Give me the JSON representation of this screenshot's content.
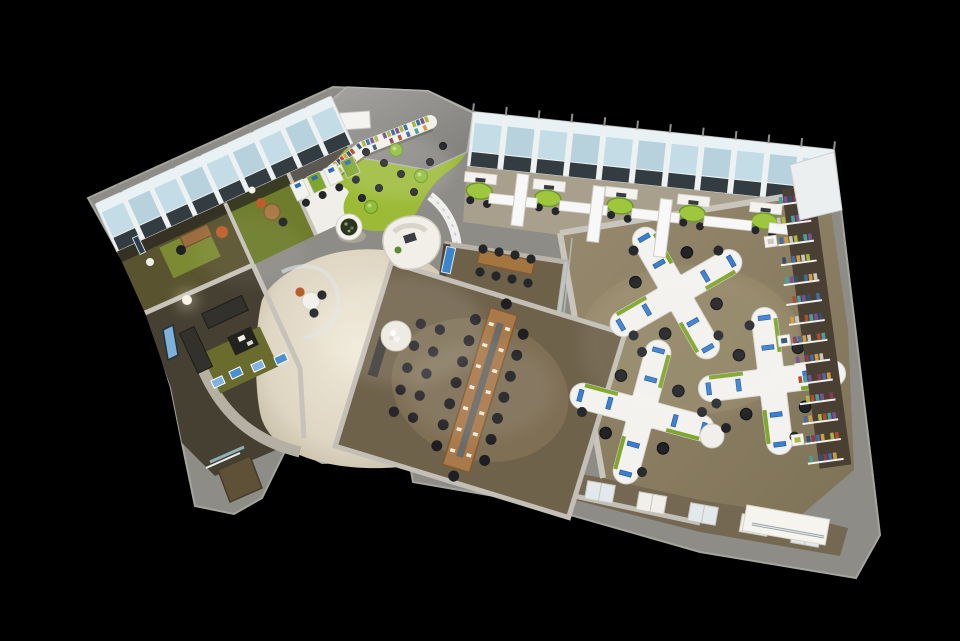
{
  "meta": {
    "description": "3D isometric cutaway rendering of an open-plan office floor plan on a black background",
    "background": "#000000"
  },
  "palette": {
    "outer_wall": "#8d8c86",
    "wall_top": "#c7c3ba",
    "wall_dark_face": "#4e4435",
    "roof": "#9a9995",
    "frame_white": "#eef1f2",
    "glass": "#c3dce6",
    "glass_light": "#e8f1f4",
    "glass_dark_pane": "#1e282e",
    "carpet_open_office": "#8d8169",
    "carpet_conference": "#6f624b",
    "pods_floor": "#a89f8d",
    "lobby_beige": "#ded5c2",
    "lobby_highlight": "#f0e9d8",
    "floor_green": "#9cba36",
    "table_green": "#9ec73e",
    "rug_olive": "#7c8a33",
    "lounge_floor": "#454031",
    "wood": "#a9794a",
    "wood_dark": "#7d5a33",
    "chair_black": "#24262a",
    "furniture_white": "#f3f2ee",
    "monitor_blue": "#3b7fd1",
    "brochure_blue": "#4a8fd3",
    "accent_orange": "#bf5c2a",
    "desk_green_strip": "#7fa62e",
    "shelf_backing": "#4a3f33",
    "doormat": "#5e5137",
    "service_floor": "#756853",
    "steel": "#9ba2a6"
  },
  "scene": {
    "facade_left": {
      "outer": [
        [
          95,
          204
        ],
        [
          331,
          96
        ]
      ],
      "depth": 52,
      "windows": 9
    },
    "facade_right": {
      "outer": [
        [
          473,
          112
        ],
        [
          834,
          150
        ]
      ],
      "depth": 54,
      "windows": 11
    },
    "pods": {
      "positions_t": [
        0.04,
        0.23,
        0.43,
        0.63,
        0.83
      ],
      "fin_t": [
        0.135,
        0.33,
        0.53,
        0.73,
        0.91
      ]
    },
    "library_shelf": {
      "points": [
        [
          333,
          171
        ],
        [
          363,
          148
        ],
        [
          430,
          122
        ]
      ],
      "books_per_segment": [
        9,
        16
      ]
    },
    "book_wall": {
      "start": [
        789,
        198
      ],
      "end": [
        824,
        456
      ],
      "rows": 14,
      "books_per_row": 7
    },
    "book_colors": [
      "#b34a32",
      "#3d6ea5",
      "#45a09e",
      "#d59a3c",
      "#7b5191",
      "#c8c8c0",
      "#32506b",
      "#a8b842",
      "#8a3b52"
    ],
    "clusters": [
      {
        "cx": 676,
        "cy": 293,
        "rot": 15
      },
      {
        "cx": 642,
        "cy": 412,
        "rot": 60
      },
      {
        "cx": 772,
        "cy": 381,
        "rot": 38
      }
    ],
    "conference": {
      "cx": 480,
      "cy": 390,
      "rot": 17,
      "chairs_per_side": 7,
      "aux_columns": [
        -56,
        -76
      ],
      "aux_chairs": 5
    },
    "work_row": {
      "count": 4,
      "from": [
        300,
        190
      ],
      "to": [
        350,
        167
      ]
    },
    "cabinets": {
      "count": 5,
      "from": [
        600,
        492
      ],
      "to": [
        806,
        536
      ]
    },
    "library_stools": [
      [
        366,
        152
      ],
      [
        384,
        163
      ],
      [
        401,
        174
      ],
      [
        379,
        188
      ],
      [
        362,
        198
      ],
      [
        414,
        192
      ],
      [
        430,
        162
      ],
      [
        443,
        146
      ]
    ],
    "library_tables": [
      [
        396,
        150
      ],
      [
        421,
        176
      ],
      [
        371,
        207
      ]
    ],
    "lobby_brochures": [
      [
        218,
        382
      ],
      [
        236,
        373
      ],
      [
        258,
        366
      ],
      [
        281,
        359
      ]
    ]
  }
}
